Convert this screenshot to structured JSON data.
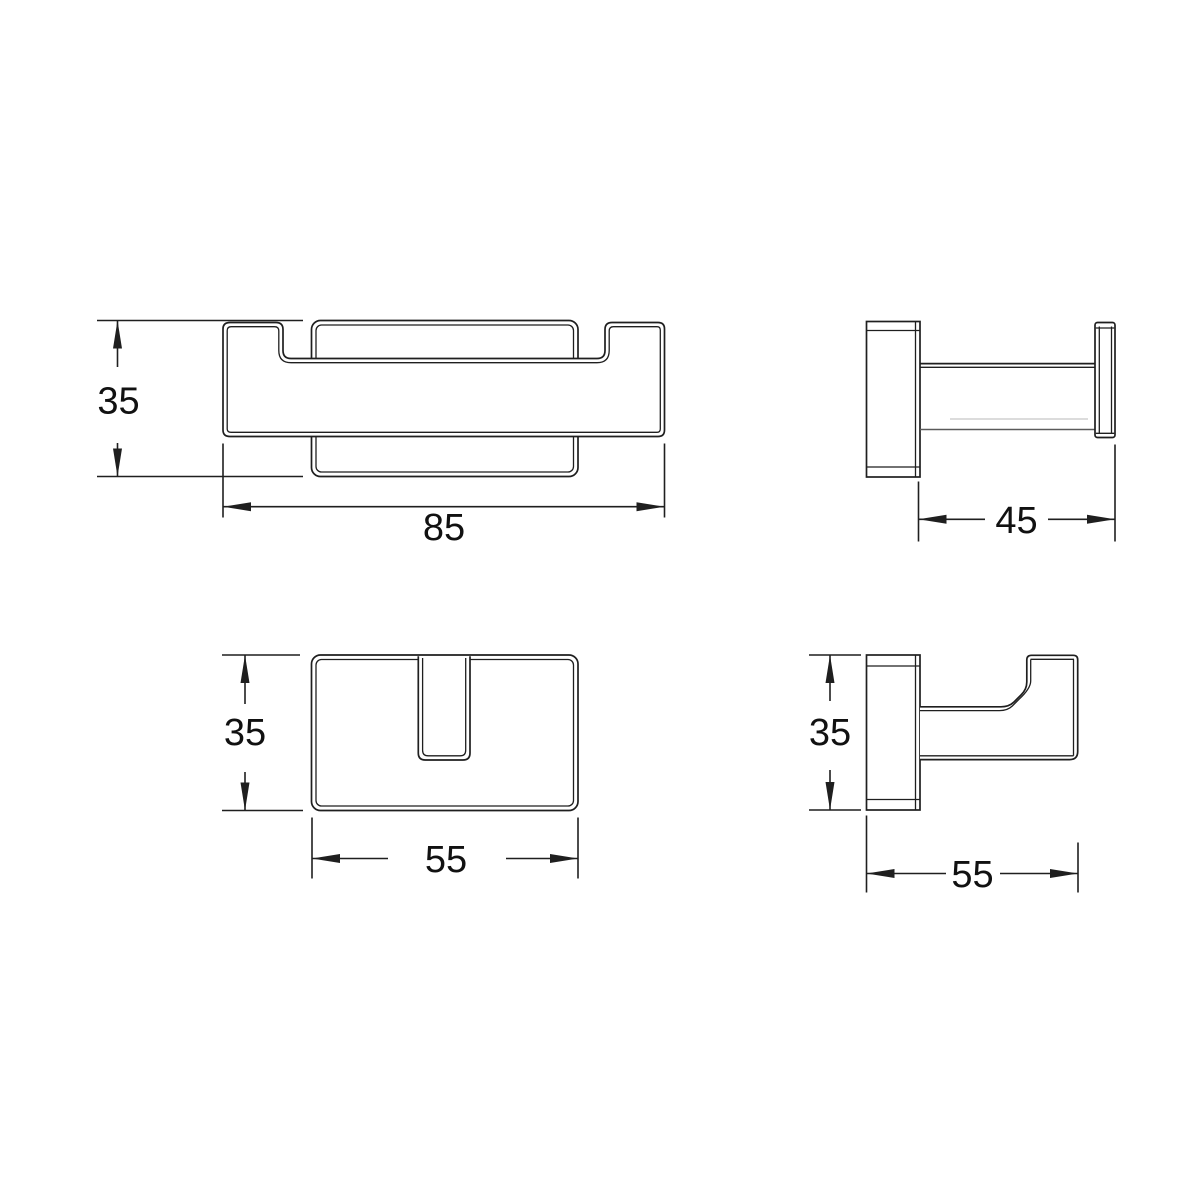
{
  "canvas": {
    "background_color": "#ffffff",
    "line_color": "#1f1f1f",
    "drawing_type": "technical-dimension-drawing"
  },
  "views": {
    "front_double": {
      "height_label": "35",
      "width_label": "85"
    },
    "side_double": {
      "depth_label": "45"
    },
    "front_single": {
      "height_label": "35",
      "width_label": "55"
    },
    "side_single": {
      "height_label": "35",
      "depth_label": "55"
    }
  }
}
